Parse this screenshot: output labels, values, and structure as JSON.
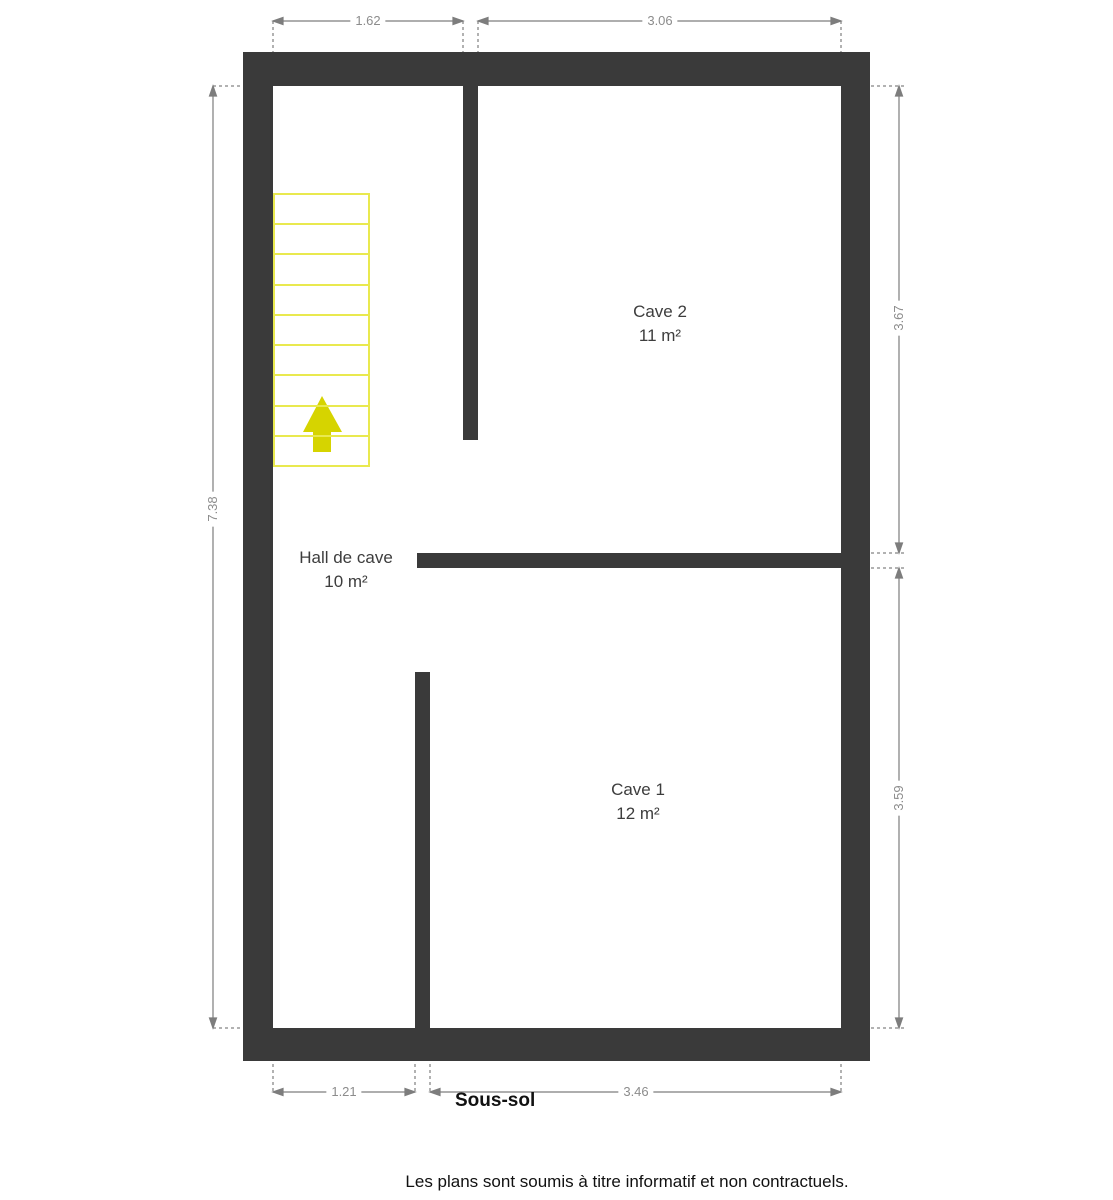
{
  "plan": {
    "floor_label": "Sous-sol",
    "rooms": [
      {
        "id": "cave2",
        "name": "Cave 2",
        "area": "11 m²"
      },
      {
        "id": "hall",
        "name": "Hall de cave",
        "area": "10 m²"
      },
      {
        "id": "cave1",
        "name": "Cave 1",
        "area": "12 m²"
      }
    ],
    "dimensions": {
      "top_left_width": "1.62",
      "top_right_width": "3.06",
      "left_height": "7.38",
      "right_top_height": "3.67",
      "right_bottom_height": "3.59",
      "bottom_left_width": "1.21",
      "bottom_right_width": "3.46"
    },
    "stairs": {
      "steps": 9,
      "direction_icon": "up-arrow"
    },
    "colors": {
      "wall": "#3a3a3a",
      "dimension_line": "#7d7d7d",
      "dimension_text": "#8c8c8c",
      "stairs_outline": "#e9e94f",
      "stairs_arrow": "#d6d400",
      "room_text": "#3d3d3d"
    }
  },
  "footer": {
    "disclaimer": "Les plans sont soumis à titre informatif et non contractuels."
  }
}
